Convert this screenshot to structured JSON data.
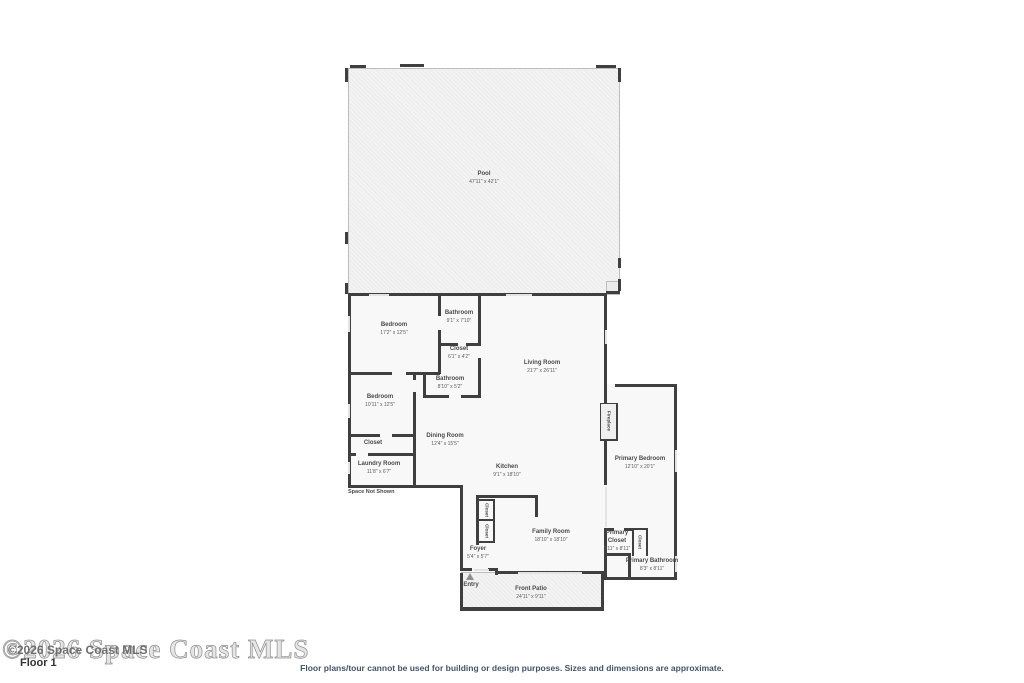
{
  "meta": {
    "floor_label": "Floor 1",
    "disclaimer": "Floor plans/tour cannot be used for building or design purposes. Sizes and dimensions are approximate.",
    "watermark_large": "©2026 Space Coast MLS",
    "watermark_small": "©2026 Space Coast MLS",
    "space_not_shown": "Space Not Shown"
  },
  "colors": {
    "wall": "#3f3f3f",
    "room_fill": "#f8f8f8",
    "pool_fill": "#f3f3f3",
    "label_text": "#4a4a4a",
    "footer_text": "#44546a"
  },
  "rooms": {
    "pool": {
      "name": "Pool",
      "dims": "47'11\" x 42'1\""
    },
    "bedroom_top": {
      "name": "Bedroom",
      "dims": "17'2\" x 12'5\""
    },
    "bathroom_top": {
      "name": "Bathroom",
      "dims": "9'1\" x 7'10\""
    },
    "closet_hall": {
      "name": "Closet",
      "dims": "6'1\" x 4'2\""
    },
    "bathroom_hall": {
      "name": "Bathroom",
      "dims": "8'10\" x 5'2\""
    },
    "living_room": {
      "name": "Living Room",
      "dims": "21'7\" x 26'11\""
    },
    "bedroom_left": {
      "name": "Bedroom",
      "dims": "10'11\" x 12'5\""
    },
    "closet_left": {
      "name": "Closet"
    },
    "laundry_room": {
      "name": "Laundry Room",
      "dims": "11'8\" x 6'7\""
    },
    "dining_room": {
      "name": "Dining Room",
      "dims": "12'4\" x 15'5\""
    },
    "kitchen": {
      "name": "Kitchen",
      "dims": "9'1\" x 18'10\""
    },
    "kitchen_closet_1": {
      "name": "Closet"
    },
    "kitchen_closet_2": {
      "name": "Closet"
    },
    "family_room": {
      "name": "Family Room",
      "dims": "18'10\" x 18'10\""
    },
    "foyer": {
      "name": "Foyer",
      "dims": "5'4\" x 5'7\""
    },
    "entry": {
      "name": "Entry"
    },
    "front_patio": {
      "name": "Front Patio",
      "dims": "24'11\" x 9'11\""
    },
    "fireplace": {
      "name": "Fireplace"
    },
    "primary_bedroom": {
      "name": "Primary Bedroom",
      "dims": "12'10\" x 20'1\""
    },
    "primary_closet": {
      "name": "Primary Closet",
      "dims": "5'11\" x 8'11\""
    },
    "primary_closet_small": {
      "name": "Closet"
    },
    "primary_bathroom": {
      "name": "Primary Bathroom",
      "dims": "8'3\" x 8'11\""
    }
  }
}
